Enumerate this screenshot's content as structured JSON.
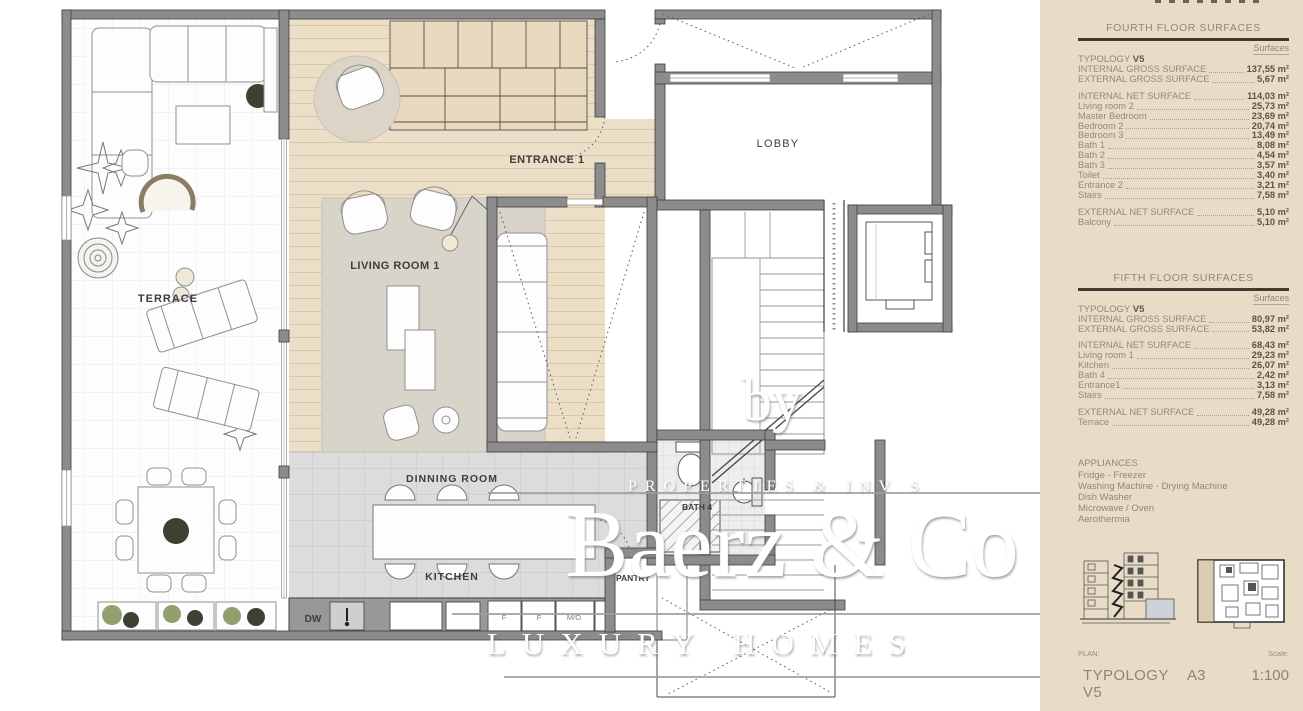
{
  "floorplan": {
    "labels": {
      "terrace": "TERRACE",
      "entrance": "ENTRANCE 1",
      "living_room": "LIVING ROOM 1",
      "lobby": "LOBBY",
      "dining_room": "DINNING ROOM",
      "kitchen": "KITCHEN",
      "bath4": "BATH 4",
      "pantry": "PANTRY",
      "dishwasher": "DW"
    },
    "appliance_labels": [
      "F",
      "F",
      "M/O"
    ],
    "colors": {
      "wall": "#8c8c8c",
      "wood_floor": "#ecdfc8",
      "closet": "#e9dabf",
      "rug": "#d9d4c9",
      "kitchen_tile": "#dcdcdc",
      "label_text": "#3d3d3d"
    }
  },
  "watermark": {
    "by": "by",
    "properties": "PROPERTIES & INV S",
    "brand": "Baerz & Co",
    "homes": "LUXURY HOMES"
  },
  "sidebar": {
    "colors": {
      "background": "#e8dcc6",
      "text": "#8f8779",
      "value": "#5a5348",
      "rule": "#403a2f"
    },
    "fourth_floor": {
      "title": "FOURTH FLOOR SURFACES",
      "col_header": "Surfaces",
      "typology_label": "TYPOLOGY",
      "typology_value": "V5",
      "rows": [
        {
          "label": "INTERNAL GROSS SURFACE",
          "value": "137,55 m²",
          "strong": true
        },
        {
          "label": "EXTERNAL GROSS SURFACE",
          "value": "5,67 m²",
          "strong": true
        },
        {
          "label": "INTERNAL NET SURFACE",
          "value": "114,03 m²",
          "strong": true,
          "gap_before": true
        },
        {
          "label": "Living room 2",
          "value": "25,73 m²"
        },
        {
          "label": "Master Bedroom",
          "value": "23,69 m²"
        },
        {
          "label": "Bedroom 2",
          "value": "20,74 m²"
        },
        {
          "label": "Bedroom 3",
          "value": "13,49 m²"
        },
        {
          "label": "Bath 1",
          "value": "8,08 m²"
        },
        {
          "label": "Bath 2",
          "value": "4,54 m²"
        },
        {
          "label": "Bath 3",
          "value": "3,57 m²"
        },
        {
          "label": "Toilet",
          "value": "3,40 m²"
        },
        {
          "label": "Entrance 2",
          "value": "3,21 m²"
        },
        {
          "label": "Stairs",
          "value": "7,58 m²"
        },
        {
          "label": "EXTERNAL NET SURFACE",
          "value": "5,10 m²",
          "strong": true,
          "gap_before": true
        },
        {
          "label": "Balcony",
          "value": "5,10 m²"
        }
      ]
    },
    "fifth_floor": {
      "title": "FIFTH FLOOR SURFACES",
      "col_header": "Surfaces",
      "typology_label": "TYPOLOGY",
      "typology_value": "V5",
      "rows": [
        {
          "label": "INTERNAL GROSS SURFACE",
          "value": "80,97 m²",
          "strong": true
        },
        {
          "label": "EXTERNAL GROSS SURFACE",
          "value": "53,82 m²",
          "strong": true
        },
        {
          "label": "INTERNAL NET SURFACE",
          "value": "68,43 m²",
          "strong": true,
          "gap_before": true
        },
        {
          "label": "Living room 1",
          "value": "29,23 m²"
        },
        {
          "label": "Kitchen",
          "value": "26,07 m²"
        },
        {
          "label": "Bath 4",
          "value": "2,42 m²"
        },
        {
          "label": "Entrance1",
          "value": "3,13 m²"
        },
        {
          "label": "Stairs",
          "value": "7,58 m²"
        },
        {
          "label": "EXTERNAL NET SURFACE",
          "value": "49,28 m²",
          "strong": true,
          "gap_before": true
        },
        {
          "label": "Terrace",
          "value": "49,28 m²"
        }
      ]
    },
    "appliances": {
      "title": "APPLIANCES",
      "items": [
        "Fridge - Freezer",
        "Washing Machine - Drying Machine",
        "Dish Washer",
        "Microwave / Oven",
        "Aerothermia"
      ]
    },
    "plan_block": {
      "plan_label": "PLAN:",
      "scale_label": "Scale:",
      "rows": [
        {
          "name": "TYPOLOGY V5",
          "sheet": "A3",
          "scale": "1:100"
        },
        {
          "name": "FIFTH FLOOR",
          "sheet": "A1",
          "scale": "1:50"
        }
      ]
    }
  }
}
